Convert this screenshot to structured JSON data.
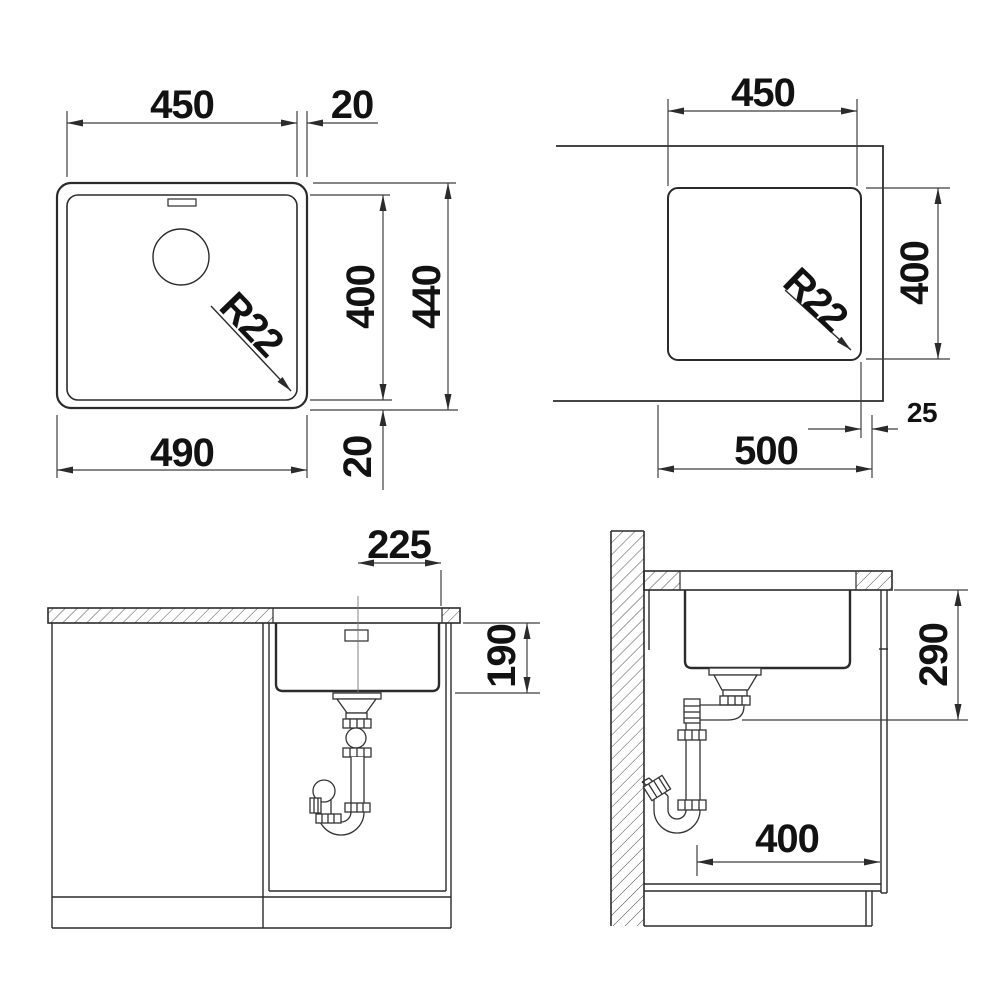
{
  "drawing": {
    "type": "sink-installation-technical-drawing",
    "colors": {
      "line": "#2b2b2b",
      "thin_line": "#3f3f3f",
      "hatch": "#4d4d4d",
      "text": "#121212",
      "background": "#ffffff"
    },
    "views": {
      "top": {
        "title": "sink-top-view",
        "dims": {
          "inner_width": "450",
          "rim_top": "20",
          "inner_depth": "400",
          "outer_depth": "440",
          "outer_width": "490",
          "rim_bottom": "20",
          "corner_radius": "R22"
        }
      },
      "cutout": {
        "title": "worktop-cutout-view",
        "dims": {
          "cutout_width": "450",
          "cutout_depth": "400",
          "edge_distance": "25",
          "cabinet_width": "500",
          "corner_radius": "R22"
        }
      },
      "front": {
        "title": "front-section-view",
        "dims": {
          "drain_center_offset": "225",
          "bowl_depth": "190"
        }
      },
      "side": {
        "title": "side-section-view",
        "dims": {
          "clearance_height": "290",
          "cabinet_depth": "400"
        }
      }
    }
  }
}
